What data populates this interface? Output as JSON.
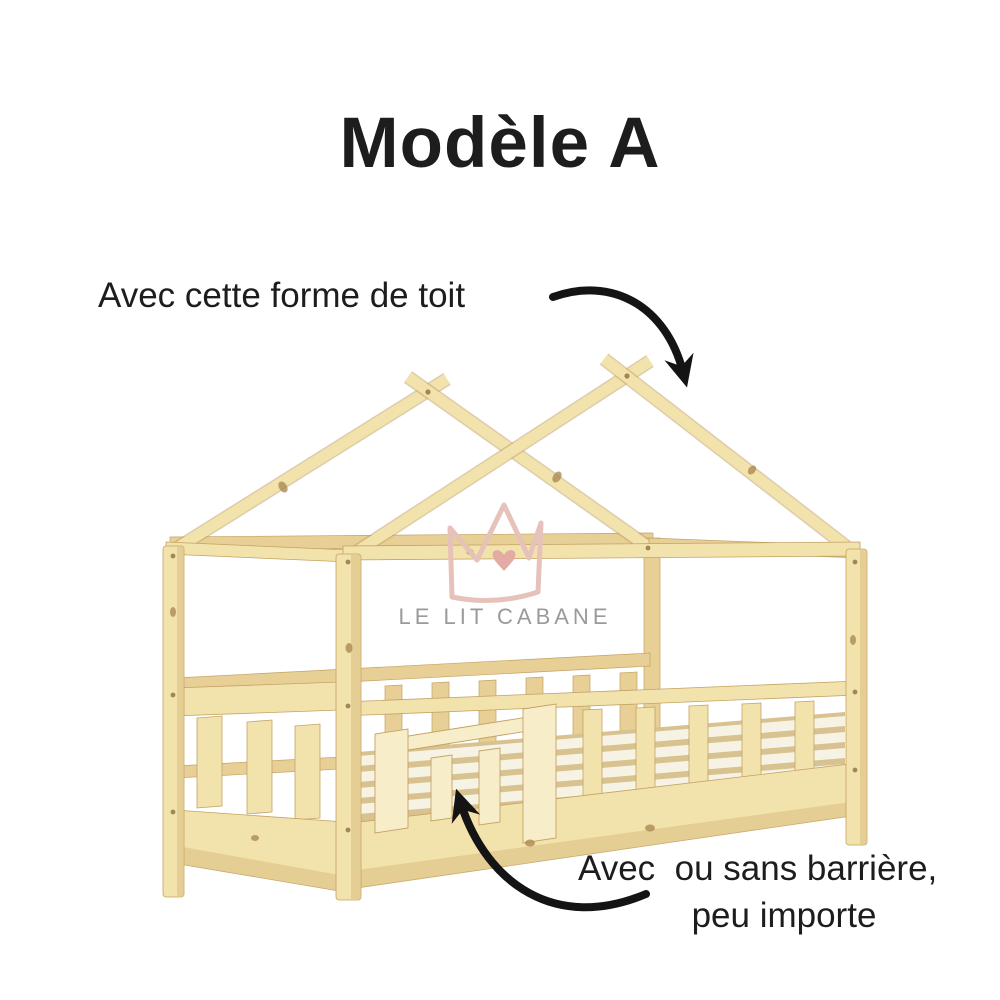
{
  "title": "Modèle A",
  "callouts": {
    "roof": {
      "label": "Avec cette forme de toit",
      "arrow_icon": "curved-arrow-down-to-roof"
    },
    "barrier": {
      "label_line1": "Avec  ou sans barrière,",
      "label_line2": "peu importe",
      "arrow_icon": "curved-arrow-up-to-barrier"
    }
  },
  "watermark": {
    "brand": "LE LIT CABANE",
    "logo_icon": "crown-with-heart"
  },
  "illustration": {
    "subject": "Lit cabane en bois naturel avec barrières à barreaux (wooden house-frame kids bed, scissor-cross roof, slatted safety rails)"
  },
  "colors": {
    "background": "#ffffff",
    "text": "#1d1d1d",
    "arrow": "#141414",
    "wood": "#f2e2ab",
    "wood-light": "#f7edc9",
    "wood-mid": "#e7cf96",
    "wood-shadow": "#d9bd80",
    "wood-edge": "#c3a365",
    "knot": "#a5854e",
    "slat-white": "#f7f3e4",
    "slat-shadow": "#d8c290",
    "crown-pink": "#e6c2ba",
    "heart-pink": "#e3aba3",
    "brand-gray": "#9a9a9a"
  }
}
